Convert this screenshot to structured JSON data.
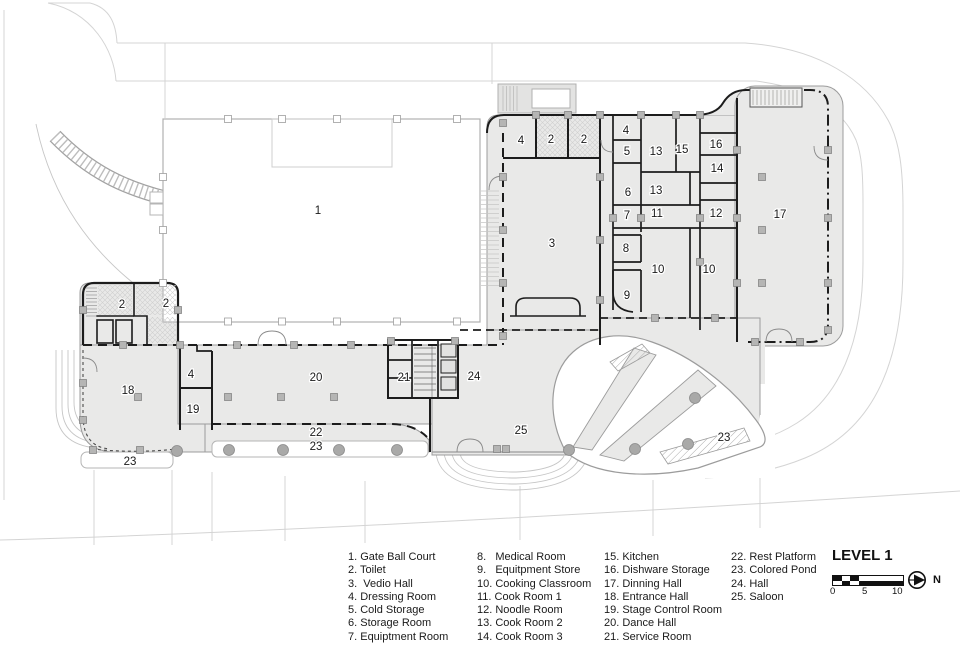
{
  "plan": {
    "colors": {
      "wall": "#1c1c1c",
      "building": "#e9e9e8",
      "outline": "#9c9c9c",
      "site": "#d4d4d4",
      "column": "#b5b5b4",
      "text": "#1a1a1a"
    },
    "room_labels": [
      {
        "t": "1",
        "x": 318,
        "y": 210
      },
      {
        "t": "4",
        "x": 521,
        "y": 140
      },
      {
        "t": "2",
        "x": 551,
        "y": 139
      },
      {
        "t": "2",
        "x": 584,
        "y": 139
      },
      {
        "t": "3",
        "x": 552,
        "y": 243
      },
      {
        "t": "4",
        "x": 626,
        "y": 130
      },
      {
        "t": "5",
        "x": 627,
        "y": 151
      },
      {
        "t": "13",
        "x": 656,
        "y": 151
      },
      {
        "t": "15",
        "x": 682,
        "y": 149
      },
      {
        "t": "16",
        "x": 716,
        "y": 144
      },
      {
        "t": "14",
        "x": 717,
        "y": 168
      },
      {
        "t": "6",
        "x": 628,
        "y": 192
      },
      {
        "t": "13",
        "x": 656,
        "y": 190
      },
      {
        "t": "7",
        "x": 627,
        "y": 215
      },
      {
        "t": "11",
        "x": 657,
        "y": 213
      },
      {
        "t": "12",
        "x": 716,
        "y": 213
      },
      {
        "t": "8",
        "x": 626,
        "y": 248
      },
      {
        "t": "10",
        "x": 658,
        "y": 269
      },
      {
        "t": "10",
        "x": 709,
        "y": 269
      },
      {
        "t": "9",
        "x": 627,
        "y": 295
      },
      {
        "t": "17",
        "x": 780,
        "y": 214
      },
      {
        "t": "2",
        "x": 122,
        "y": 304
      },
      {
        "t": "2",
        "x": 166,
        "y": 303
      },
      {
        "t": "18",
        "x": 128,
        "y": 390
      },
      {
        "t": "4",
        "x": 191,
        "y": 374
      },
      {
        "t": "19",
        "x": 193,
        "y": 409
      },
      {
        "t": "20",
        "x": 316,
        "y": 377
      },
      {
        "t": "21",
        "x": 404,
        "y": 377
      },
      {
        "t": "24",
        "x": 474,
        "y": 376
      },
      {
        "t": "25",
        "x": 521,
        "y": 430
      },
      {
        "t": "22",
        "x": 316,
        "y": 432
      },
      {
        "t": "23",
        "x": 316,
        "y": 446
      },
      {
        "t": "23",
        "x": 130,
        "y": 461
      },
      {
        "t": "23",
        "x": 724,
        "y": 437
      }
    ]
  },
  "titleblock": {
    "title": "LEVEL 1",
    "north_label": "N",
    "scale_ticks": [
      "0",
      "5",
      "10"
    ]
  },
  "legend": {
    "columns": [
      {
        "x": 348,
        "items": [
          "1. Gate Ball Court",
          "2. Toilet",
          "3.  Vedio Hall",
          "4. Dressing Room",
          "5. Cold Storage",
          "6. Storage Room",
          "7. Equiptment Room"
        ]
      },
      {
        "x": 477,
        "items": [
          "8.   Medical Room",
          "9.   Equitpment Store",
          "10. Cooking Classroom",
          "11. Cook Room 1",
          "12. Noodle Room",
          "13. Cook Room 2",
          "14. Cook Room 3"
        ]
      },
      {
        "x": 604,
        "items": [
          "15. Kitchen",
          "16. Dishware Storage",
          "17. Dinning Hall",
          "18. Entrance Hall",
          "19. Stage Control Room",
          "20. Dance Hall",
          "21. Service Room"
        ]
      },
      {
        "x": 731,
        "items": [
          "22. Rest Platform",
          "23. Colored Pond",
          "24. Hall",
          "25. Saloon"
        ]
      }
    ]
  }
}
